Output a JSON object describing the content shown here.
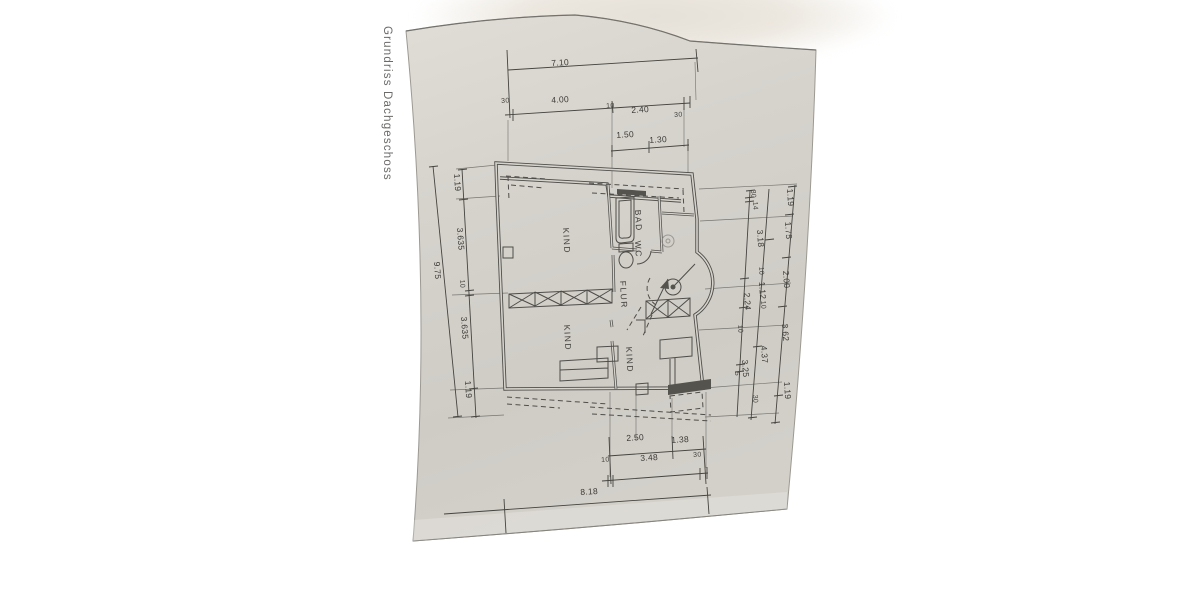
{
  "caption": "Grundriss Dachgeschoss",
  "rooms": [
    "KIND",
    "BAD",
    "WC",
    "FLUR",
    "KIND",
    "KIND"
  ],
  "dims": {
    "top": [
      "7.10",
      "30",
      "4.00",
      "10",
      "2.40",
      "30",
      "1.50",
      "1.30"
    ],
    "left": [
      "1.19",
      "3.635",
      "10",
      "3.635",
      "1.19",
      "9.75"
    ],
    "right": [
      "1.19",
      "1.75",
      "2.00",
      "3.62",
      "1.19",
      "30",
      "14",
      "3.18",
      "10",
      "1.12",
      "10",
      "2.24",
      "10",
      "4.37",
      "3.25",
      "5",
      "30"
    ],
    "bottom": [
      "2.50",
      "1.38",
      "10",
      "3.48",
      "30",
      "8.18"
    ]
  },
  "colors": {
    "paper": "#d5d2cc",
    "ink": "#4f4d49",
    "background": "#ffffff"
  }
}
